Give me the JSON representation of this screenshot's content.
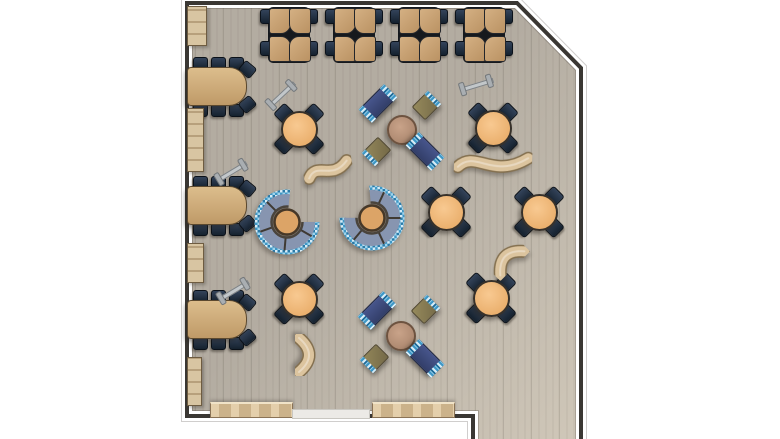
{
  "scene": {
    "type": "furniture-floor-plan-top-view",
    "canvas": {
      "width": 780,
      "height": 439
    },
    "room_outline_points": "187,3 517,3 581,68 581,439 473,439 473,416 187,416",
    "wall_path": "M 473,439 L 473,416 L 187,416 L 187,3 L 517,3 L 581,68 L 581,439"
  },
  "colors": {
    "background": "#ffffff",
    "floor": "#b3aca1",
    "floor_light_tint": "rgba(236,226,208,0.5)",
    "wall": "#3a3733",
    "wall_outline": "#ffffff",
    "desk_wood": "#c9a478",
    "table_wood": "#cfa873",
    "cabinet_wood": "#c9b593",
    "bench_wood": "#dcc49e",
    "chair_navy": "#1d2b3a",
    "round_table_top": "#efb377",
    "booth_table_top": "#dca467",
    "coffee_table_top": "#b38e75",
    "sofa_navy": "#3d4a78",
    "ottoman_khaki": "#877a55",
    "mosaic_blue": "#3e97c6",
    "mosaic_light": "#d6ecf7",
    "booth_seat": "#8795b0",
    "whiteboard_gray": "#c2c7ca",
    "door_mat": "#eceae6"
  },
  "furniture": {
    "desk_clusters": [
      {
        "x": 260,
        "y": 6
      },
      {
        "x": 325,
        "y": 6
      },
      {
        "x": 390,
        "y": 6
      },
      {
        "x": 455,
        "y": 6
      }
    ],
    "long_tables": [
      {
        "x": 187,
        "y": 67
      },
      {
        "x": 187,
        "y": 186
      },
      {
        "x": 187,
        "y": 300
      }
    ],
    "cabinets": [
      {
        "x": 187,
        "y": 6,
        "w": 18,
        "h": 38
      },
      {
        "x": 187,
        "y": 108,
        "w": 15,
        "h": 62
      },
      {
        "x": 187,
        "y": 243,
        "w": 15,
        "h": 38
      },
      {
        "x": 187,
        "y": 357,
        "w": 13,
        "h": 47
      }
    ],
    "whiteboards": [
      {
        "cx": 281,
        "cy": 95,
        "rot": -43
      },
      {
        "cx": 476,
        "cy": 85,
        "rot": -17
      },
      {
        "cx": 231,
        "cy": 172,
        "rot": -31
      },
      {
        "cx": 233,
        "cy": 291,
        "rot": -31
      }
    ],
    "round_tables": [
      {
        "cx": 298,
        "cy": 128
      },
      {
        "cx": 492,
        "cy": 127
      },
      {
        "cx": 445,
        "cy": 211
      },
      {
        "cx": 538,
        "cy": 211
      },
      {
        "cx": 298,
        "cy": 298
      },
      {
        "cx": 490,
        "cy": 297
      }
    ],
    "booths": [
      {
        "cx": 287,
        "cy": 222,
        "rot": 0
      },
      {
        "cx": 372,
        "cy": 218,
        "rot": -95
      }
    ],
    "wave_benches": [
      {
        "cx": 328,
        "cy": 170,
        "rot": -10,
        "kind": "s-small"
      },
      {
        "cx": 493,
        "cy": 164,
        "rot": 2,
        "kind": "s-large"
      },
      {
        "cx": 506,
        "cy": 257,
        "rot": -45,
        "kind": "arc"
      },
      {
        "cx": 308,
        "cy": 355,
        "rot": 90,
        "kind": "arc"
      }
    ],
    "lounge_items": [
      {
        "t": "sofa",
        "cx": 377,
        "cy": 102,
        "rot": -45
      },
      {
        "t": "ottoman",
        "cx": 425,
        "cy": 104,
        "rot": -45,
        "edge": "right"
      },
      {
        "t": "coffee_table",
        "cx": 400,
        "cy": 128,
        "rot": 0
      },
      {
        "t": "ottoman",
        "cx": 375,
        "cy": 150,
        "rot": -45,
        "edge": "left"
      },
      {
        "t": "sofa",
        "cx": 424,
        "cy": 150,
        "rot": 45
      },
      {
        "t": "sofa",
        "cx": 376,
        "cy": 309,
        "rot": -45
      },
      {
        "t": "ottoman",
        "cx": 424,
        "cy": 308,
        "rot": -45,
        "edge": "right"
      },
      {
        "t": "coffee_table",
        "cx": 399,
        "cy": 334,
        "rot": 0
      },
      {
        "t": "ottoman",
        "cx": 373,
        "cy": 357,
        "rot": -45,
        "edge": "left"
      },
      {
        "t": "sofa",
        "cx": 424,
        "cy": 357,
        "rot": 45
      }
    ],
    "wall_benches": [
      {
        "x": 210,
        "y": 402,
        "w": 81,
        "h": 13
      },
      {
        "x": 372,
        "y": 402,
        "w": 81,
        "h": 13
      }
    ],
    "door_mat": {
      "x": 292,
      "y": 409,
      "w": 76,
      "h": 8
    }
  }
}
